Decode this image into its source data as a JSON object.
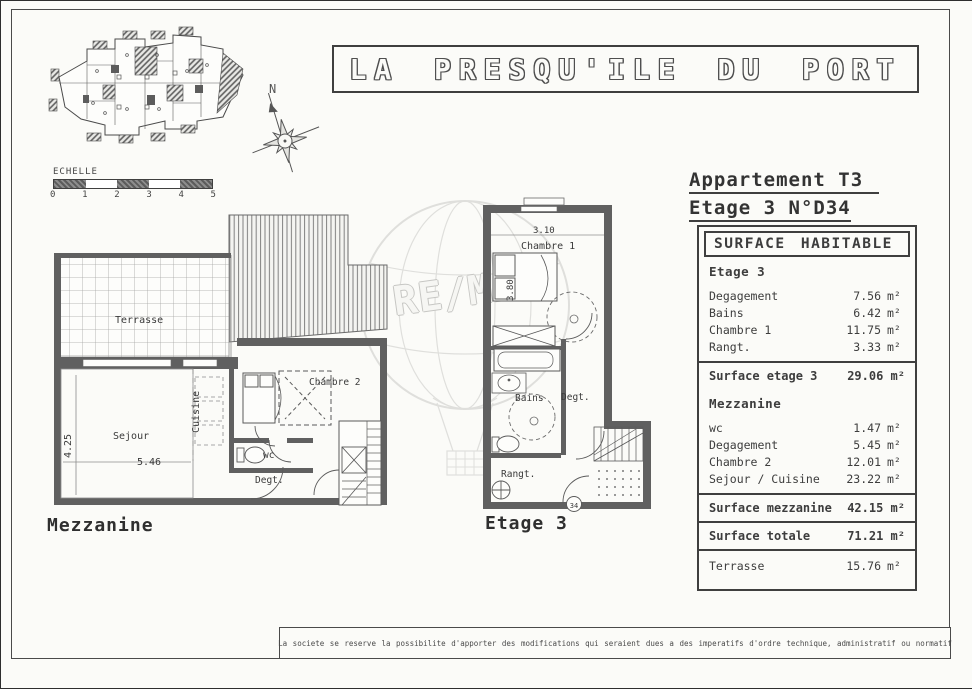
{
  "title_box": {
    "text": "LA PRESQU'ILE DU PORT"
  },
  "scale_bar": {
    "label": "ECHELLE",
    "ticks": [
      "0",
      "1",
      "2",
      "3",
      "4",
      "5"
    ]
  },
  "compass": {
    "north": "N"
  },
  "watermark": {
    "brand": "RE/MAX"
  },
  "apartment_header": {
    "line1": "Appartement T3",
    "line2": "Etage 3 N°D34"
  },
  "surface_table": {
    "title": "SURFACE HABITABLE",
    "sections": [
      {
        "heading": "Etage 3",
        "rows": [
          {
            "label": "Degagement",
            "value": "7.56",
            "unit": "m²"
          },
          {
            "label": "Bains",
            "value": "6.42",
            "unit": "m²"
          },
          {
            "label": "Chambre 1",
            "value": "11.75",
            "unit": "m²"
          },
          {
            "label": "Rangt.",
            "value": "3.33",
            "unit": "m²"
          }
        ],
        "subtotal_label": "Surface etage 3",
        "subtotal_value": "29.06 m²"
      },
      {
        "heading": "Mezzanine",
        "rows": [
          {
            "label": "wc",
            "value": "1.47",
            "unit": "m²"
          },
          {
            "label": "Degagement",
            "value": "5.45",
            "unit": "m²"
          },
          {
            "label": "Chambre 2",
            "value": "12.01",
            "unit": "m²"
          },
          {
            "label": "Sejour / Cuisine",
            "value": "23.22",
            "unit": "m²"
          }
        ],
        "subtotal_label": "Surface mezzanine",
        "subtotal_value": "42.15 m²"
      }
    ],
    "total_label": "Surface totale",
    "total_value": "71.21 m²",
    "terrasse_label": "Terrasse",
    "terrasse_value": "15.76",
    "terrasse_unit": "m²"
  },
  "plan_mezzanine": {
    "caption": "Mezzanine",
    "rooms": {
      "terrasse": "Terrasse",
      "sejour": "Sejour",
      "cuisine": "Cuisine",
      "chambre2": "Chambre 2",
      "wc": "wc",
      "degt": "Degt."
    },
    "dims": {
      "height": "4.25",
      "width": "5.46"
    }
  },
  "plan_etage3": {
    "caption": "Etage 3",
    "rooms": {
      "chambre1": "Chambre 1",
      "bains": "Bains",
      "degt": "Degt.",
      "rangt": "Rangt."
    },
    "dims": {
      "width": "3.10",
      "depth": "3.80"
    },
    "badge": "34"
  },
  "footer": {
    "disclaimer": "La societe se reserve la possibilite d'apporter des modifications qui seraient dues a des imperatifs d'ordre technique, administratif ou normatif"
  },
  "colors": {
    "ink": "#3d3d3d",
    "paper": "#fbfbf8",
    "wall": "#606060"
  }
}
